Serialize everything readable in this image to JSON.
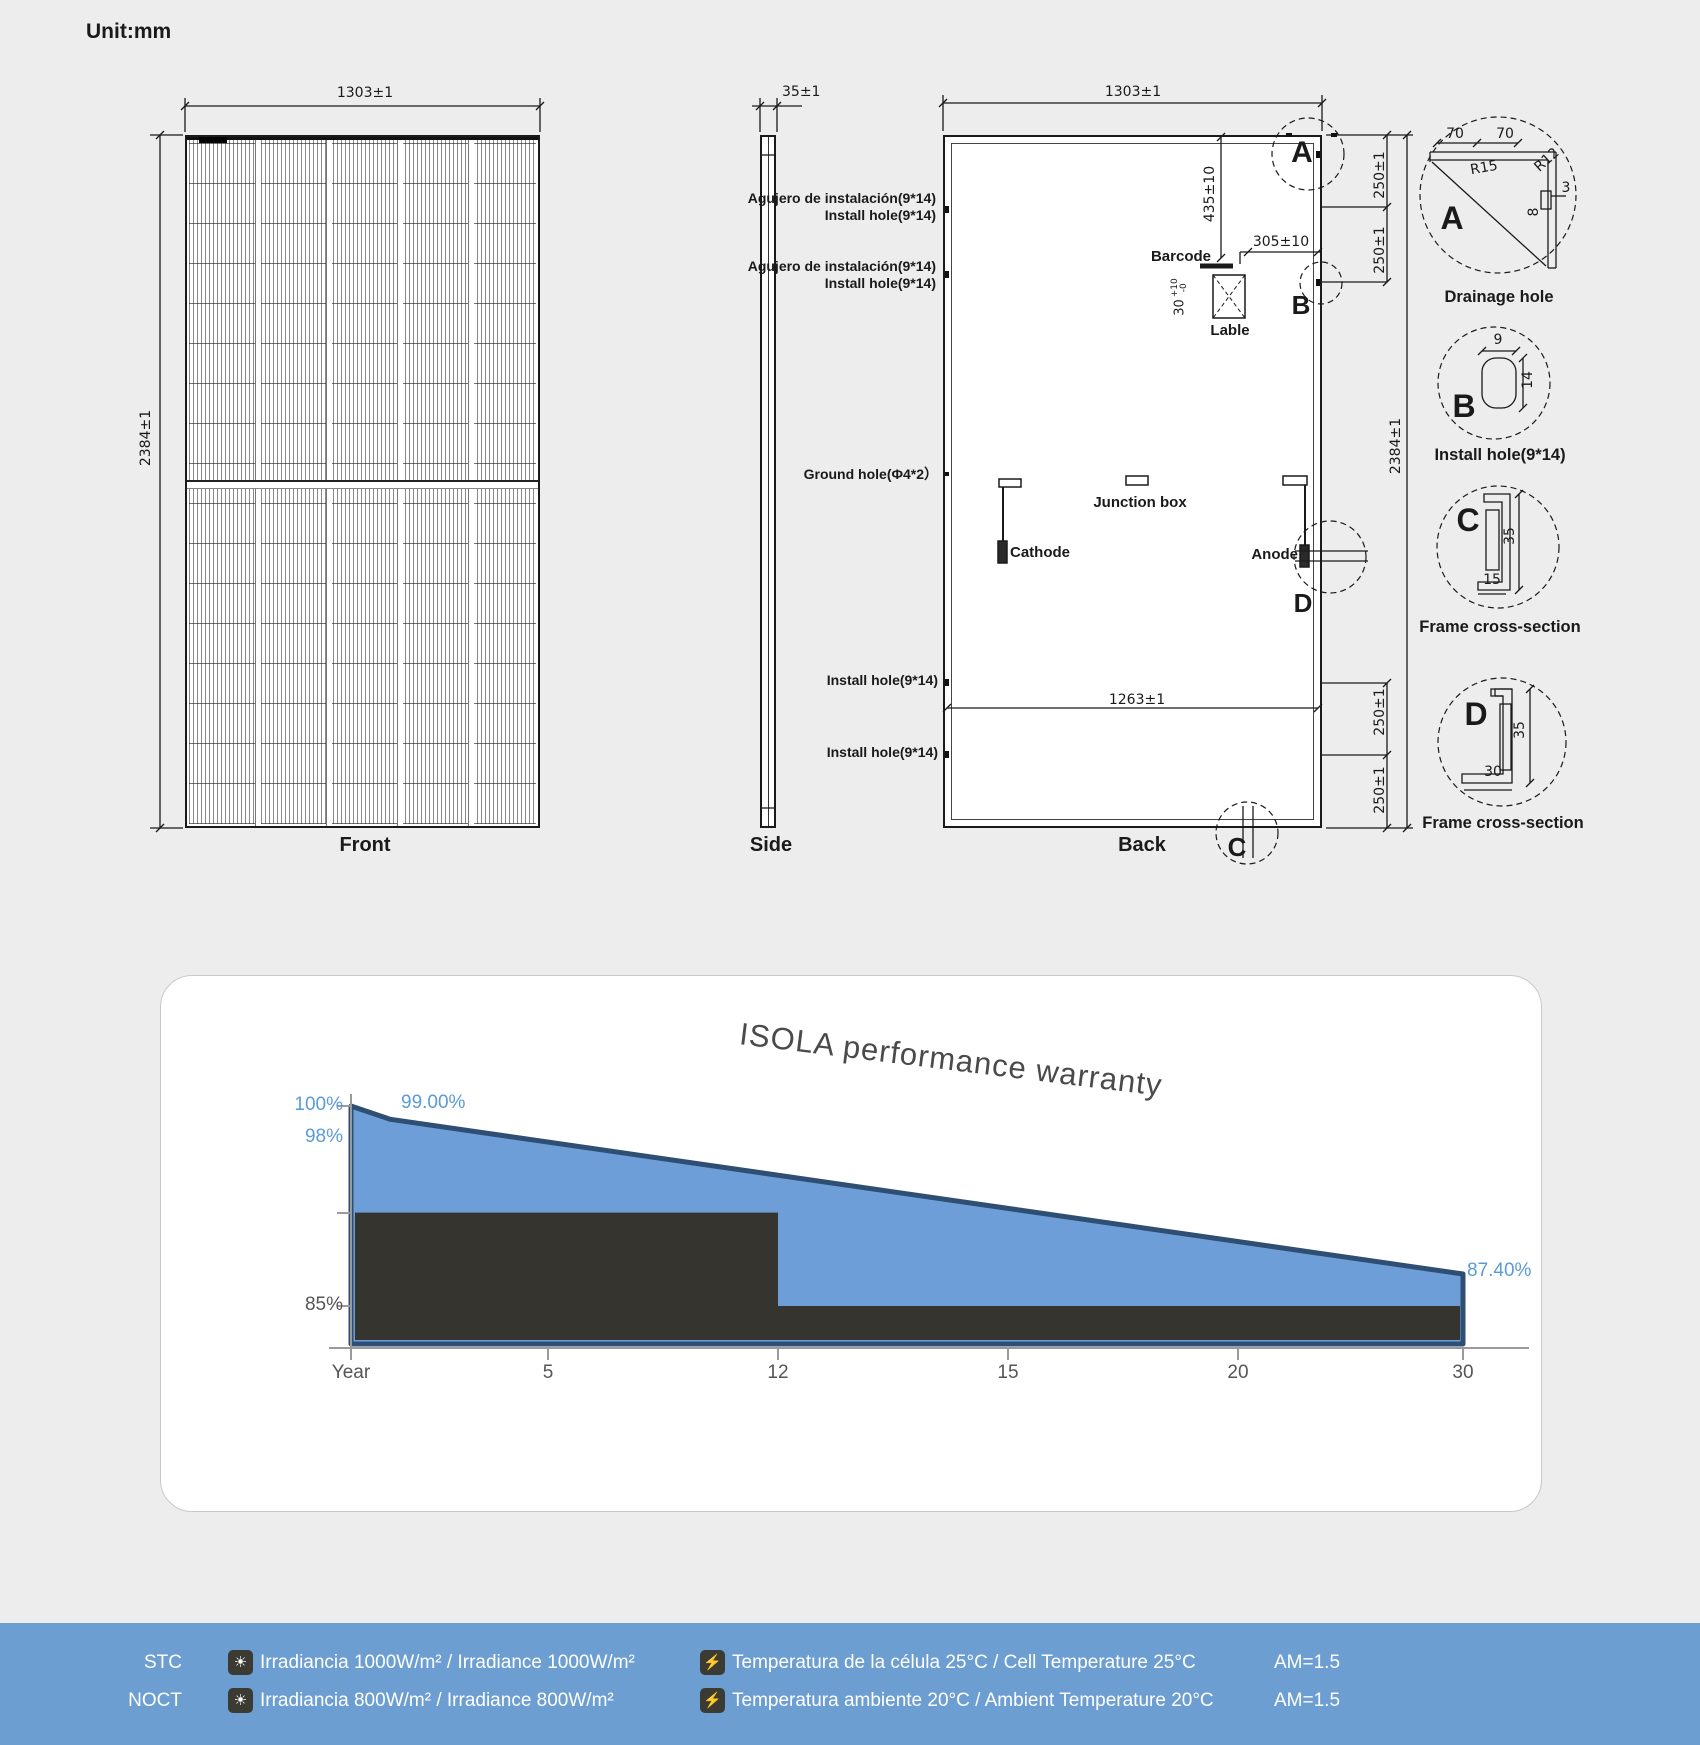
{
  "page": {
    "unit_label": "Unit:mm"
  },
  "views": {
    "front": {
      "label": "Front",
      "dim_width": "1303±1",
      "dim_height": "2384±1"
    },
    "side": {
      "label": "Side",
      "dim_thickness": "35±1"
    },
    "back": {
      "label": "Back",
      "dim_width": "1303±1",
      "dim_height": "2384±1",
      "dim_hole_span": "1263±1",
      "dim_barcode_offset": "435±10",
      "dim_label_offset": "305±10",
      "label_size": {
        "value": "30",
        "tol_plus": "+10",
        "tol_minus": "-0"
      },
      "dim_corner_spacing": [
        "250±1",
        "250±1",
        "250±1",
        "250±1"
      ],
      "barcode": "Barcode",
      "lable": "Lable",
      "junction_box": "Junction box",
      "cathode": "Cathode",
      "anode": "Anode",
      "callouts": [
        [
          "Agujero de instalación(9*14)",
          "Install hole(9*14)"
        ],
        [
          "Agujero de instalación(9*14)",
          "Install hole(9*14)"
        ],
        [
          "Ground hole(Φ4*2）"
        ],
        [
          "Install hole(9*14)"
        ],
        [
          "Install hole(9*14)"
        ]
      ],
      "section_marks": [
        "A",
        "B",
        "C",
        "D"
      ]
    },
    "details": [
      {
        "letter": "A",
        "caption": "Drainage hole",
        "dims": {
          "d1": "70",
          "d2": "70",
          "r1": "R15",
          "r2": "R12",
          "t": "3",
          "h": "8"
        }
      },
      {
        "letter": "B",
        "caption": "Install hole(9*14)",
        "dims": {
          "w": "9",
          "h": "14"
        }
      },
      {
        "letter": "C",
        "caption": "Frame cross-section",
        "dims": {
          "h": "35",
          "w": "15"
        }
      },
      {
        "letter": "D",
        "caption": "Frame cross-section",
        "dims": {
          "h": "35",
          "w": "30"
        }
      }
    ]
  },
  "chart_data": {
    "type": "area",
    "title": "ISOLA performance warranty",
    "xlabel": "Year",
    "x_tick_labels": [
      "Year",
      "5",
      "12",
      "15",
      "20",
      "30"
    ],
    "x_ticks_evenly_spaced": true,
    "y_tick_labels": [
      "100%",
      "98%",
      "85%"
    ],
    "ylim": [
      82,
      101
    ],
    "grid": false,
    "legend": "none",
    "series": [
      {
        "name": "ISOLA linear performance warranty",
        "style": "area-line",
        "fill": "#6d9ed8",
        "stroke": "#2e4e74",
        "x": [
          0,
          1,
          30
        ],
        "values": [
          100,
          99,
          87.4
        ]
      },
      {
        "name": "Conventional step warranty",
        "style": "area-step",
        "fill": "#35342e",
        "stroke": "none",
        "x": [
          0,
          12,
          12,
          30
        ],
        "values": [
          92,
          92,
          85,
          85
        ]
      }
    ],
    "annotations": [
      {
        "text": "99.00%",
        "x": 1,
        "y": 99
      },
      {
        "text": "87.40%",
        "x": 30,
        "y": 87.4
      }
    ]
  },
  "footer": {
    "rows": [
      {
        "condition": "STC",
        "irradiance": "Irradiancia 1000W/m²  / Irradiance 1000W/m²",
        "temperature": "Temperatura de la célula 25°C / Cell Temperature 25°C",
        "air_mass": "AM=1.5"
      },
      {
        "condition": "NOCT",
        "irradiance": "Irradiancia 800W/m² / Irradiance 800W/m²",
        "temperature": "Temperatura ambiente 20°C / Ambient Temperature 20°C",
        "air_mass": "AM=1.5"
      }
    ],
    "icons": {
      "irradiance": "sun-icon",
      "temperature": "battery-lightning-icon"
    }
  },
  "colors": {
    "page_bg": "#ededee",
    "card_bg": "#ffffff",
    "card_border": "#c9c9c9",
    "line": "#1a1a1a",
    "chart_blue_fill": "#6d9ed8",
    "chart_blue_stroke": "#2e4e74",
    "chart_dark_fill": "#35342e",
    "chart_blue_text": "#5b9bd5",
    "chart_axis": "#9a9a9a",
    "chart_tick_text": "#555555",
    "footer_bg": "#6d9ed2",
    "footer_text": "#ffffff",
    "icon_bg": "#3c3b33"
  }
}
